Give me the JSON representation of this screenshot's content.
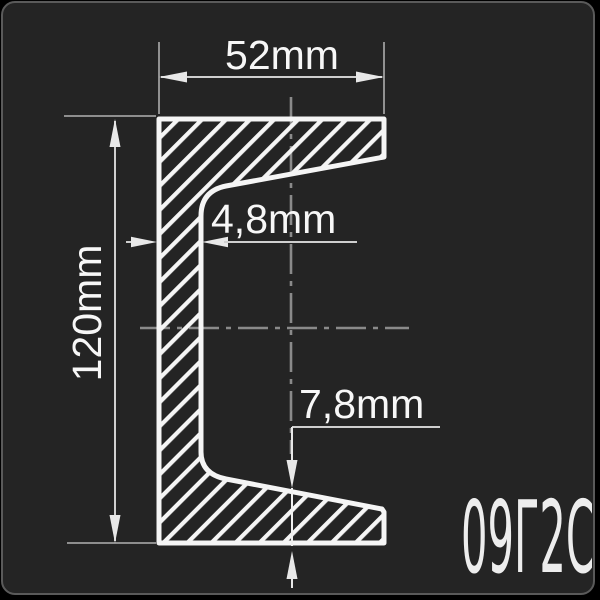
{
  "card": {
    "background": "#242424",
    "border_color": "#5a5a5a"
  },
  "drawing": {
    "type": "channel-steel-cross-section",
    "dimensions": {
      "flange_width": "52mm",
      "profile_height": "120mm",
      "web_thickness": "4,8mm",
      "flange_thickness": "7,8mm"
    },
    "steel_grade": "09Г2С",
    "colors": {
      "outline": "#f5f5f5",
      "hatch": "#f5f5f5",
      "dimension_line": "#cfcfcf",
      "extension_line": "#9e9e9e",
      "centerline": "#8a8a8a",
      "text": "#f7f7f7"
    }
  }
}
